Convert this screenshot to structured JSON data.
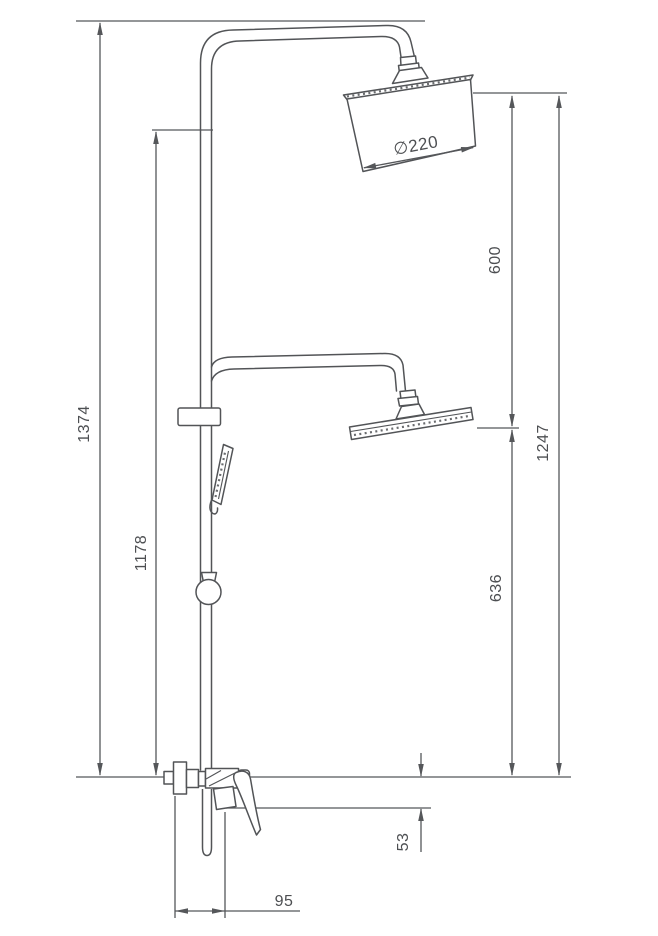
{
  "drawing": {
    "title": "Shower column technical drawing",
    "kind": "technical-diagram",
    "line_color": "#55575a",
    "text_color": "#4d4f52",
    "background": "#ffffff",
    "labels": {
      "total_height": "1374",
      "hand_shower_rail_height": "1178",
      "head_to_lower_head": "600",
      "top_head_to_base": "1247",
      "lower_head_to_base": "636",
      "spout_drop": "53",
      "wall_to_spout": "95",
      "head_diameter": "∅220"
    }
  }
}
